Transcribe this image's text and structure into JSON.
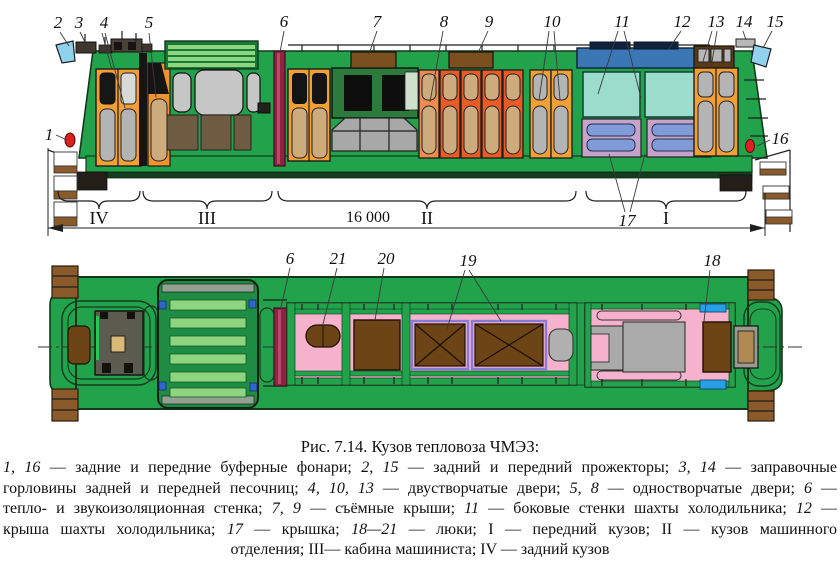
{
  "figure": {
    "title": "Рис. 7.14. Кузов тепловоза ЧМЭЗ:",
    "caption_lines": [
      [
        {
          "t": "1, 16",
          "i": true
        },
        {
          "t": " — задние и передние буферные фонари; ",
          "i": false
        },
        {
          "t": "2, 15",
          "i": true
        },
        {
          "t": " — задний и передний прожекторы; ",
          "i": false
        },
        {
          "t": "3, 14",
          "i": true
        },
        {
          "t": " — заправочные",
          "i": false
        }
      ],
      [
        {
          "t": "горловины задней и передней песочниц; ",
          "i": false
        },
        {
          "t": "4, 10, 13",
          "i": true
        },
        {
          "t": " — двустворчатые двери; ",
          "i": false
        },
        {
          "t": "5, 8",
          "i": true
        },
        {
          "t": " — одностворчатые двери; ",
          "i": false
        },
        {
          "t": "6",
          "i": true
        },
        {
          "t": " —",
          "i": false
        }
      ],
      [
        {
          "t": "тепло- и звукоизоляционная стенка; ",
          "i": false
        },
        {
          "t": "7, 9",
          "i": true
        },
        {
          "t": " — съёмные крыши; ",
          "i": false
        },
        {
          "t": "11",
          "i": true
        },
        {
          "t": " — боковые стенки шахты холодильника; ",
          "i": false
        },
        {
          "t": "12",
          "i": true
        },
        {
          "t": " —",
          "i": false
        }
      ],
      [
        {
          "t": "крыша шахты холодильника; ",
          "i": false
        },
        {
          "t": "17",
          "i": true
        },
        {
          "t": " — крышка; ",
          "i": false
        },
        {
          "t": "18—21",
          "i": true
        },
        {
          "t": " — люки; I — передний кузов; II — кузов машинного",
          "i": false
        }
      ],
      [
        {
          "t": "отделения; III— кабина машиниста; IV — задний кузов",
          "i": false
        }
      ]
    ]
  },
  "side_view": {
    "callouts": [
      "1",
      "2",
      "3",
      "4",
      "5",
      "6",
      "7",
      "8",
      "9",
      "10",
      "11",
      "12",
      "13",
      "14",
      "15",
      "16",
      "17"
    ],
    "section_labels": [
      "IV",
      "III",
      "II",
      "I"
    ],
    "dimension": "16 000"
  },
  "plan_view": {
    "callouts": [
      "6",
      "21",
      "20",
      "19",
      "18"
    ]
  },
  "colors": {
    "body_green": "#21a24b",
    "dark_green": "#157a38",
    "stripe_green": "#8fd47f",
    "orange_yellow": "#f2a035",
    "orange_red": "#ea5a24",
    "orange_salmon": "#f08a4e",
    "tan_panel": "#cdab7c",
    "gray_panel": "#b4b4b4",
    "maroon_wall": "#8e2443",
    "blue_roof": "#3b77b5",
    "teal_wall": "#9cdccd",
    "lavender_frame": "#c7a3cb",
    "slat_blue": "#809bd8",
    "light_blue": "#90d2ee",
    "signal_red": "#dd1f1f",
    "brown_hatch": "#6d4415",
    "roof_brown": "#7c4f1e",
    "pink_roof": "#f6b2cc",
    "purple_frame": "#8a7ad8",
    "bright_blue": "#28a0e8",
    "step_brown": "#8a5a2a"
  }
}
